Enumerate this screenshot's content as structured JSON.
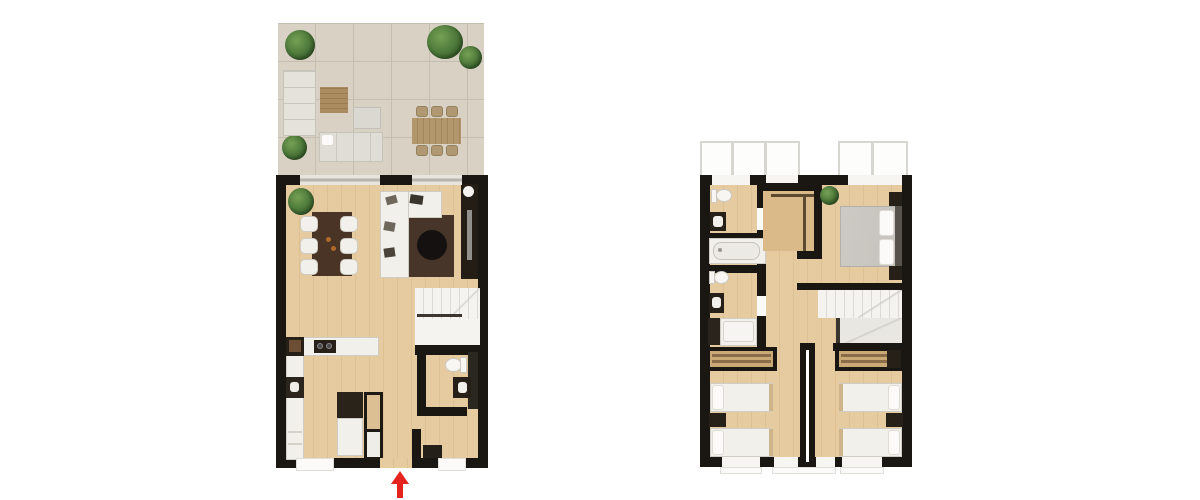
{
  "canvas": {
    "width": 1200,
    "height": 500,
    "background": "#ffffff"
  },
  "colors": {
    "wall": "#1a1713",
    "floor": "#e6cba0",
    "floor_stripe": "#dfc092",
    "tile": "#d8d1c4",
    "tile_line": "#c6bfb1",
    "white_furniture": "#f2f0ea",
    "furniture_border": "#cfccc3",
    "dark_furniture": "#262019",
    "wood_furniture": "#ae9064",
    "rug": "#463528",
    "bed_gray": "#c6c2bd",
    "plant_green": "#4a7638",
    "arrow_red": "#e3241f",
    "stair_white": "#f4f3f0",
    "glass": "#b8b4ab"
  },
  "plans": [
    {
      "id": "ground-floor",
      "outdoor": [
        "terrace",
        "outdoor-corner-sofa",
        "outdoor-coffee-table",
        "outdoor-ottoman",
        "outdoor-lounge-sofa",
        "outdoor-dining-table",
        "outdoor-chairs-x6",
        "plants-x4"
      ],
      "indoor": [
        "dining-table-with-6-chairs",
        "corner-sofa",
        "rug",
        "round-coffee-table",
        "tv-unit",
        "stairs",
        "kitchen-counter",
        "kitchen-island",
        "tall-cabinet",
        "bathroom-toilet",
        "bathroom-sink",
        "entry-bench",
        "plant"
      ]
    },
    {
      "id": "upper-floor",
      "indoor": [
        "balcony-windows-x2",
        "wc-toilet",
        "wc-sink",
        "bathtub",
        "bathroom2-toilet",
        "bathroom2-sink",
        "shower",
        "walk-in-closet",
        "plant",
        "master-double-bed",
        "nightstands-x2",
        "stairs",
        "twin-bedroom-left",
        "twin-bedroom-right",
        "wardrobes-x2"
      ]
    }
  ],
  "entrance": {
    "symbol": "arrow-up",
    "color": "#e3241f"
  }
}
